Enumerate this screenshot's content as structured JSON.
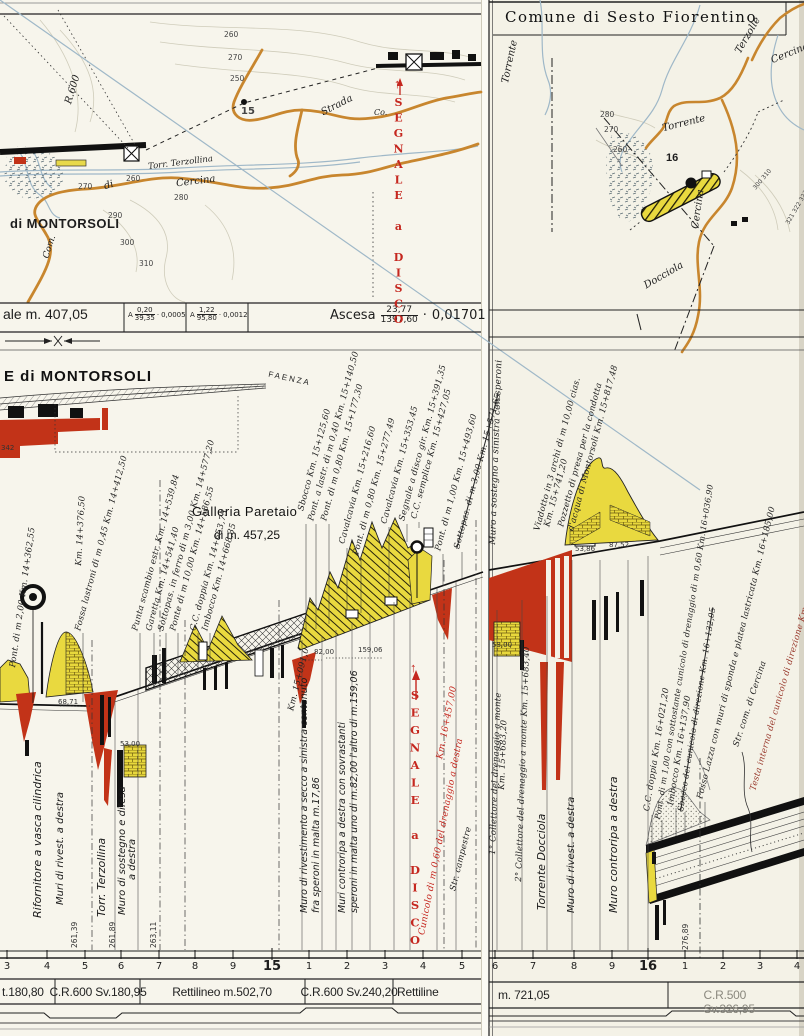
{
  "header": {
    "title": "Comune  di  Sesto Fiorentino"
  },
  "signals": {
    "top": "SEGNALE a DISCO",
    "bottom": "SEGNALE a DISCO",
    "arrow": "↑"
  },
  "map_left": {
    "labels": [
      "260",
      "270",
      "250",
      "15",
      "Strada",
      "R.600",
      "Torr. Terzollina",
      "Cercina",
      "di",
      "260",
      "270",
      "280",
      "290",
      "300",
      "310",
      "di MONTORSOLI",
      "Com.",
      "Co."
    ]
  },
  "map_right": {
    "labels": [
      "Terzolle",
      "Cercina",
      "Torrente",
      "Torrente",
      "16",
      "280",
      "270",
      "260",
      "Cercina",
      "Docciola",
      "300  310",
      "321 322 323"
    ]
  },
  "gradeband": {
    "left_label": "ale m. 407,05",
    "sep": "·",
    "frac1_prefix": "A",
    "frac1_num": "0,20",
    "frac1_den": "39,35",
    "frac1_val": "0,0005",
    "frac2_prefix": "A",
    "frac2_num": "1,22",
    "frac2_den": "95,80",
    "frac2_val": "0,0012",
    "ascesa_label": "Ascesa",
    "ascesa_num": "23,77",
    "ascesa_den": "1397,60",
    "ascesa_val": "0,01701"
  },
  "profile": {
    "station": "E di MONTORSOLI",
    "faenza": "FAENZA",
    "gallery_line1": "Galleria  Paretaio",
    "gallery_line2": "di  m. 457,25",
    "elev": "342",
    "annotations": [
      "Pont. di m 2,00 Km. 14+362,55",
      "Km. 14+376,50",
      "Fossa lastroni di m 0,45 Km. 14+412,50",
      "Punta scambio estr. Km. 14+539,84",
      "Garetta Km. 14+541,40",
      "Sottopas. in ferro di m 3,00 Km. 14+577,20",
      "Ponte di m 10,00 Km. 14+586,55",
      "C.C. doppia Km. 14+653,75",
      "Imbocco Km. 14+668,35",
      "Sbocco Km. 15+125,60",
      "Pont. a lastr. di m 0,40 Km. 15+140,50",
      "Pont. di m 0,80 Km. 15+177,30",
      "Cavalcavia Km. 15+216,60",
      "Pont. di m 0,80 Km. 15+277,49",
      "Cavalcavia Km. 15+353,45",
      "Segnale a disco gir. Km. 15+391,35",
      "C.C. semplice Km. 15+427,05",
      "Pont. di m 1,00 Km. 15+493,60",
      "Sottopas. di m 3,00 Km. 15+571,65",
      "Muro a sostegno a sinistra con speroni",
      "Viadotto in 3 archi di m 10,00 cias.",
      "Km. 15+741,20",
      "Pozzetto di presa per la condotta",
      "d'acqua di Montorsoli Km. 15+817,48",
      "C.C. doppia Km. 16+021,20",
      "Pont. di m 1,00 con sottostante cunicolo di drenaggio di m 0,60 Km. 16+036,90",
      "Imbocco Km. 16+137,90",
      "Sbocco del cunicolo di direzione Km. 16+132,05",
      "Fosso Lazza con muri di sponda e platea lastricata Km. 16+185,00",
      "Str. com. di Cercina",
      "Testa interna del cunicolo di direzione Km. 16+316,65",
      "Cunicolo di m 0,60 del drenaggio a destra",
      "Km. 16+457,00",
      "Km. 15+091,0",
      "Str. campestre",
      "1° Collettore del drenaggio a monte",
      "Km. 15+683,20",
      "2° Collettore del drenaggio a monte Km. 15+683,40"
    ],
    "wall_labels": [
      "Rifornitore a vasca cilindrica",
      "Muri di rivest. a destra",
      "Torr. Terzollina",
      "Muro di sostegno e difesa",
      "a destra",
      "Muro di rivestimento a secco a sinistra contenuto",
      "fra speroni in malta m.17,86",
      "Muri controripa a destra con sovrastanti",
      "speroni in malta uno di m.82,00 l'altro di m.159,06",
      "Torrente  Docciola",
      "Muro di rivest. a destra",
      "Muro controripa a destra"
    ],
    "measures": [
      "68,71",
      "53,00",
      "82,00",
      "159,06",
      "53,00",
      "53,86",
      "87,52"
    ],
    "distances": [
      "261,39",
      "261,89",
      "263,11",
      "276,89"
    ]
  },
  "ruler": {
    "left": [
      "3",
      "4",
      "5",
      "6",
      "7",
      "8",
      "9",
      "15",
      "1",
      "2",
      "3",
      "4",
      "5"
    ],
    "right": [
      "6",
      "7",
      "8",
      "9",
      "16",
      "1",
      "2",
      "3",
      "4"
    ]
  },
  "curveband": {
    "left": [
      "t.180,80",
      "C.R.600 Sv.180,95",
      "Rettilineo  m.502,70",
      "C.R.600 Sv.240,20",
      "Rettiline"
    ],
    "right": [
      "m. 721,05",
      "C.R.500 Sv.326,95"
    ]
  }
}
